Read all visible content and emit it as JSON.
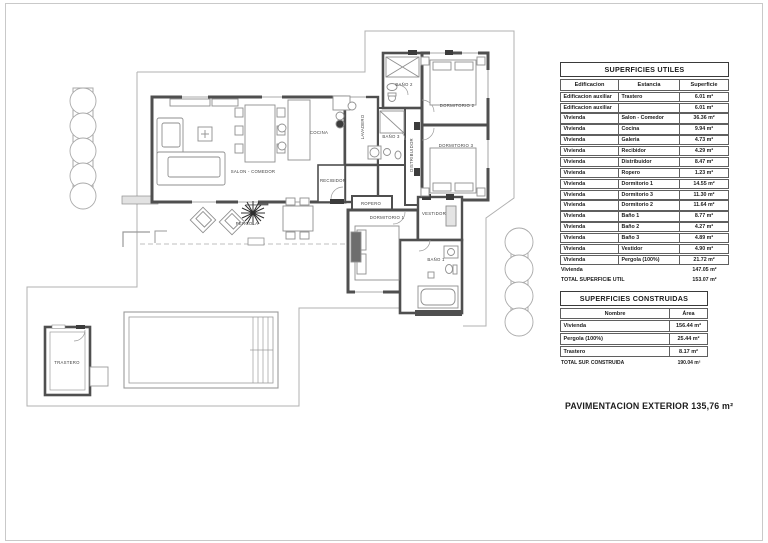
{
  "plan": {
    "rooms": {
      "salon": "SALON - COMEDOR",
      "cocina": "COCINA",
      "recibidor": "RECIBIDOR",
      "lavadero": "LAVADERO",
      "bano2": "BAÑO 2",
      "bano3": "BAÑO 3",
      "distribuidor": "DISTRIBUIDOR",
      "dormitorio2": "DORMITORIO 2",
      "dormitorio3": "DORMITORIO 3",
      "ropero": "ROPERO",
      "dormitorio1": "DORMITORIO 1",
      "vestidor": "VESTIDOR",
      "bano1": "BAÑO 1",
      "pergola": "PERGOLA",
      "trastero": "TRASTERO"
    },
    "colors": {
      "wall": "#4f4f4f",
      "thin": "#b0b0b0",
      "furniture": "#8f8f8f"
    }
  },
  "tables": {
    "utiles": {
      "title": "SUPERFICIES UTILES",
      "headers": [
        "Edificacion",
        "Estancia",
        "Superficie"
      ],
      "rows": [
        [
          "Edificacion auxiliar",
          "Trastero",
          "6.01 m²"
        ],
        [
          "Edificacion auxiliar",
          "",
          "6.01 m²"
        ],
        [
          "Vivienda",
          "Salon - Comedor",
          "36.36 m²"
        ],
        [
          "Vivienda",
          "Cocina",
          "9.94 m²"
        ],
        [
          "Vivienda",
          "Galeria",
          "4.73 m²"
        ],
        [
          "Vivienda",
          "Recibidor",
          "4.29 m²"
        ],
        [
          "Vivienda",
          "Distribuidor",
          "8.47 m²"
        ],
        [
          "Vivienda",
          "Ropero",
          "1.23 m²"
        ],
        [
          "Vivienda",
          "Dormitorio 1",
          "14.55 m²"
        ],
        [
          "Vivienda",
          "Dormitorio 3",
          "11.30 m²"
        ],
        [
          "Vivienda",
          "Dormitorio 2",
          "11.64 m²"
        ],
        [
          "Vivienda",
          "Baño 1",
          "8.77 m²"
        ],
        [
          "Vivienda",
          "Baño 2",
          "4.27 m²"
        ],
        [
          "Vivienda",
          "Baño 3",
          "4.89 m²"
        ],
        [
          "Vivienda",
          "Vestidor",
          "4.90 m²"
        ],
        [
          "Vivienda",
          "Pergola  (100%)",
          "21.72 m²"
        ]
      ],
      "subtotal": {
        "label": "Vivienda",
        "value": "147.05 m²"
      },
      "total": {
        "label": "TOTAL SUPERFICIE UTIL",
        "value": "153.07 m²"
      }
    },
    "construidas": {
      "title": "SUPERFICIES CONSTRUIDAS",
      "headers": [
        "Nombre",
        "Área"
      ],
      "rows": [
        [
          "Vivienda",
          "156.44 m²"
        ],
        [
          "Pergola  (100%)",
          "25.44 m²"
        ],
        [
          "Trastero",
          "8.17 m²"
        ]
      ],
      "total": {
        "label": "TOTAL SUP. CONSTRUIDA",
        "value": "190.04 m²"
      }
    }
  },
  "footer": {
    "pavimentacion": "PAVIMENTACION EXTERIOR 135,76 m²"
  }
}
